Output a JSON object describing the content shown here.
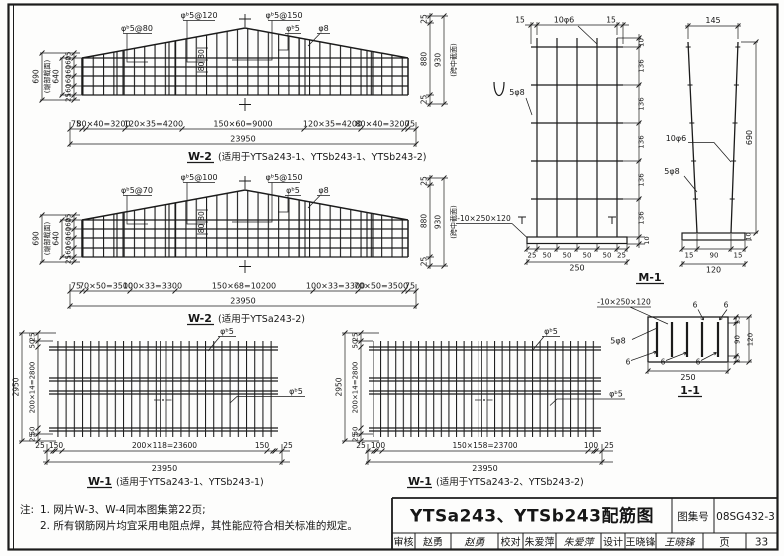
{
  "w2a": {
    "caption": "W-2",
    "caption_note": "(适用于YTSa243-1、YTSb243-1、YTSb243-2)",
    "labels": {
      "l1": "φᵇ5@80",
      "l2": "φᵇ5@120",
      "l3": "φᵇ5@150",
      "l4": "φᵇ5",
      "l5": "φ8",
      "mid": "80"
    },
    "left": {
      "margin": "25",
      "seg": "160",
      "inner": "640",
      "outer": "690",
      "note": "(端部截面)"
    },
    "right": {
      "margin": "25",
      "mid": "880",
      "outer": "930",
      "note": "(跨中截面)"
    },
    "bottom": {
      "end": "75",
      "s1": "80×40=3200",
      "s2": "120×35=4200",
      "s3": "150×60=9000",
      "total": "23950"
    }
  },
  "w2b": {
    "caption": "W-2",
    "caption_note": "(适用于YTSa243-2)",
    "labels": {
      "l1": "φᵇ5@70",
      "l2": "φᵇ5@100",
      "l3": "φᵇ5@150",
      "l4": "φᵇ5",
      "l5": "φ8",
      "mid": "80"
    },
    "left": {
      "margin": "25",
      "seg": "160",
      "inner": "640",
      "outer": "690",
      "note": "(端部截面)"
    },
    "right": {
      "margin": "25",
      "mid": "880",
      "outer": "930",
      "note": "(跨中截面)"
    },
    "bottom": {
      "end": "75",
      "s1": "70×50=3500",
      "s2": "100×33=3300",
      "s3": "150×68=10200",
      "total": "23950"
    }
  },
  "w1a": {
    "caption": "W-1",
    "caption_note": "(适用于YTSa243-1、YTSb243-1)",
    "rebar": "φᵇ5",
    "left": {
      "margin": "25",
      "offset": "50",
      "mid": "200×14=2800",
      "total": "2950"
    },
    "bottom": {
      "margin": "25",
      "offset": "150",
      "mid": "200×118=23600",
      "total": "23950"
    }
  },
  "w1b": {
    "caption": "W-1",
    "caption_note": "(适用于YTSa243-2、YTSb243-2)",
    "rebar": "φᵇ5",
    "left": {
      "margin": "25",
      "offset": "50",
      "mid": "200×14=2800",
      "total": "2950"
    },
    "bottom": {
      "margin": "25",
      "offset": "100",
      "mid": "150×158=23700",
      "total": "23950"
    }
  },
  "m1": {
    "caption": "M-1",
    "mesh": {
      "overhang": "15",
      "vbars": "10φ6",
      "hbars": "5φ8",
      "plate": "-10×250×120",
      "top": "10",
      "seg": "136",
      "plate_t": "10",
      "b_margin": "25",
      "b_seg": "50",
      "b_total": "250"
    },
    "side": {
      "top_w": "145",
      "height": "690",
      "vbars": "10φ6",
      "hbars": "5φ8",
      "b1": "15",
      "b2": "90",
      "b3": "15",
      "b_total": "120",
      "plate_t": "10"
    }
  },
  "s11": {
    "caption": "1-1",
    "plate": "-10×250×120",
    "bars": "5φ8",
    "weld": "6",
    "bottom_total": "250",
    "r_margin": "15",
    "r_mid": "90",
    "r_total": "120"
  },
  "notes": {
    "prefix": "注:",
    "line1": "1. 网片W-3、W-4同本图集第22页;",
    "line2": "2. 所有钢筋网片均宜采用电阻点焊，其性能应符合相关标准的规定。"
  },
  "title_block": {
    "title": "YTSa243、YTSb243配筋图",
    "atlas_label": "图集号",
    "atlas_no": "08SG432-3",
    "page_label": "页",
    "page_no": "33",
    "review_label": "审核",
    "reviewer": "赵勇",
    "reviewer_sig": "赵勇",
    "check_label": "校对",
    "checker": "朱爱萍",
    "checker_sig": "朱爱萍",
    "design_label": "设计",
    "designer": "王晓锋",
    "designer_sig": "王晓锋"
  }
}
